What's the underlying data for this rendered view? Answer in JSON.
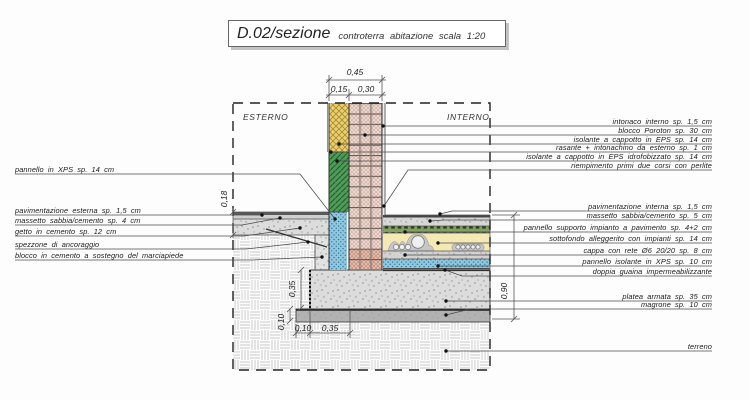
{
  "title": {
    "code": "D.02/sezione",
    "subtitle": "controterra abitazione scala 1:20"
  },
  "zones": {
    "exterior": "ESTERNO",
    "interior": "INTERNO"
  },
  "dimensions": {
    "wall_total": "0,45",
    "wall_insulation": "0,15",
    "wall_block": "0,30",
    "exterior_floor_height": "0,18",
    "interior_floor_height": "0,90",
    "platea_thickness": "0,35",
    "magrone_thickness": "0,10",
    "magrone_overhang": "0,10",
    "platea_offset": "0,35"
  },
  "labels_left": [
    "pannello in XPS sp. 14 cm",
    "pavimentazione esterna sp. 1,5 cm",
    "massetto sabbia/cemento sp. 4 cm",
    "getto in cemento sp. 12 cm",
    "spezzone di ancoraggio",
    "blocco in cemento a sostegno del marciapiede"
  ],
  "labels_right": [
    "intonaco interno sp. 1,5 cm",
    "blocco Poroton sp. 30 cm",
    "isolante a cappotto in EPS sp. 14 cm",
    "rasante + intonachino da esterno sp. 1 cm",
    "isolante a cappotto in EPS idrofobizzato sp. 14 cm",
    "riempimento primi due corsi con perlite",
    "pavimentazione interna sp. 1,5 cm",
    "massetto sabbia/cemento sp. 5 cm",
    "pannello supporto impianto a pavimento sp. 4+2 cm",
    "sottofondo alleggerito con impianti sp. 14 cm",
    "cappa con rete Ø6 20/20 sp. 8 cm",
    "pannello isolante in XPS sp. 10 cm",
    "doppia guaina impermeabilizzante",
    "platea armata sp. 35 cm",
    "magrone sp. 10 cm",
    "terreno"
  ],
  "materials_colors": {
    "eps_yellow": "#edd06e",
    "eps_green_hydro": "#4e9c57",
    "xps_blue": "#8fc8de",
    "poroton_pink": "#eadfd8",
    "perlite_courses": "#e6c3b2",
    "concrete_gray": "#dcdcdc",
    "magrone_gray": "#b2b2b2",
    "sottofondo_yellow": "#f4e9b5",
    "radiant_panel_green": "#81a060"
  }
}
